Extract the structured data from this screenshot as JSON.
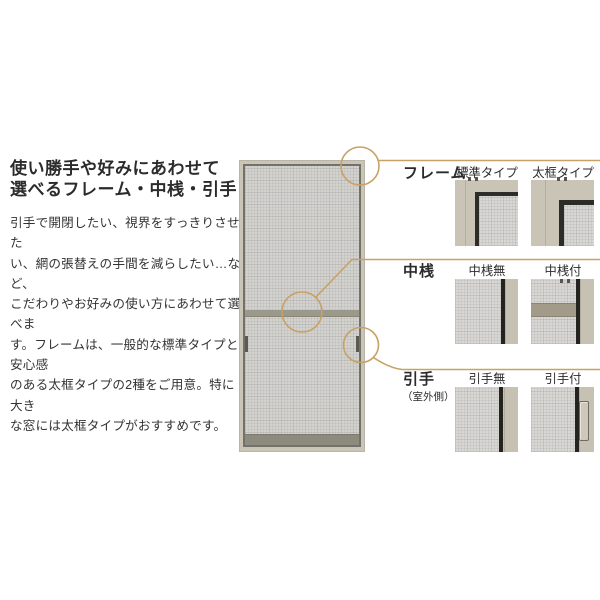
{
  "colors": {
    "accent_line": "#c8a164",
    "text": "#2b2b2b",
    "frame_beige": "#c9c4b6",
    "mesh_gray": "#d8d7d4",
    "black_frame": "#2e2c28",
    "rail_gray": "#9b988c"
  },
  "intro": {
    "heading_lines": [
      "使い勝手や好みにあわせて",
      "選べるフレーム・中桟・引手"
    ],
    "body_lines": [
      "引手で開閉したい、視界をすっきりさせた",
      "い、網の張替えの手間を減らしたい…など、",
      "こだわりやお好みの使い方にあわせて選べま",
      "す。フレームは、一般的な標準タイプと安心感",
      "のある太框タイプの2種をご用意。特に大き",
      "な窓には太框タイプがおすすめです。"
    ]
  },
  "panel": {
    "rows": [
      {
        "label": "フレーム",
        "options": [
          {
            "caption": "標準タイプ"
          },
          {
            "caption": "太框タイプ"
          }
        ]
      },
      {
        "label": "中桟",
        "options": [
          {
            "caption": "中桟無"
          },
          {
            "caption": "中桟付"
          }
        ]
      },
      {
        "label": "引手",
        "note": "（室外側）",
        "options": [
          {
            "caption": "引手無"
          },
          {
            "caption": "引手付"
          }
        ]
      }
    ]
  }
}
